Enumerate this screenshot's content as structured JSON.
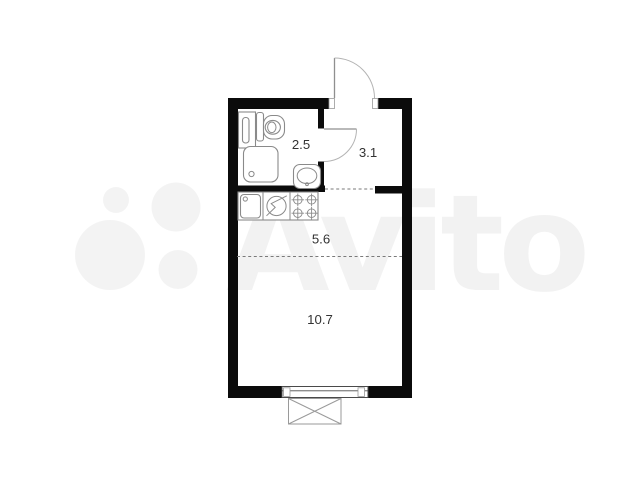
{
  "watermark": {
    "text": "Avito",
    "tint": "rgba(0,0,0,0.05)"
  },
  "plan": {
    "type": "studio-apartment-floor-plan",
    "rooms": {
      "bathroom": {
        "area": "2.5"
      },
      "hallway": {
        "area": "3.1"
      },
      "kitchen": {
        "area": "5.6"
      },
      "living_room": {
        "area": "10.7"
      }
    },
    "fixtures": [
      "washing-machine-icon",
      "toilet-icon",
      "shower-icon",
      "washbasin-icon",
      "kitchen-sink-icon",
      "hob-circle-icon",
      "stove-4-burner-icon",
      "entry-door-swing-icon",
      "bathroom-door-swing-icon",
      "window-icon",
      "balcony-icon"
    ],
    "colors": {
      "wall": "#0b0b0b",
      "fixture_line": "#8a8a8a",
      "label": "#333333",
      "background": "#ffffff"
    }
  }
}
